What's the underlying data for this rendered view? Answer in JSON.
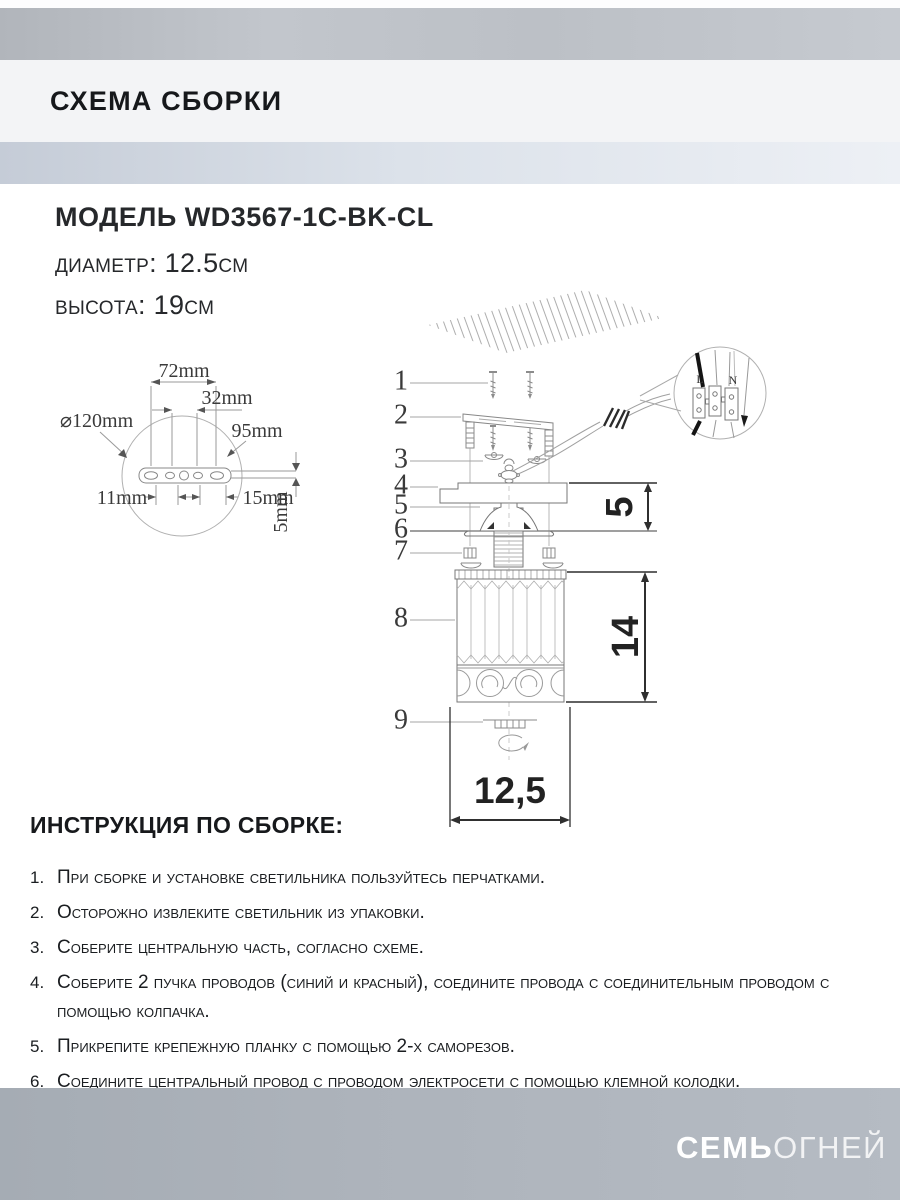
{
  "header": {
    "title": "СХЕМА СБОРКИ"
  },
  "model": {
    "name": "МОДЕЛЬ WD3567-1C-BK-CL",
    "diameter": "диаметр: 12.5см",
    "height": "высота: 19см"
  },
  "diagram": {
    "callouts": [
      "1",
      "2",
      "3",
      "4",
      "5",
      "6",
      "7",
      "8",
      "9"
    ],
    "bracket": {
      "diameter": "⌀120mm",
      "top": "72mm",
      "mid": "32mm",
      "right": "95mm",
      "left_gap": "11mm",
      "right_gap": "15mm",
      "thickness": "5mm"
    },
    "dims": {
      "canopy_height": "5",
      "body_height": "14",
      "body_width": "12,5"
    },
    "terminal": {
      "live": "L",
      "neutral": "N"
    }
  },
  "instructions": {
    "title": "ИНСТРУКЦИЯ ПО СБОРКЕ:",
    "items": [
      {
        "n": "1.",
        "text": "При сборке и установке светильника пользуйтесь перчатками."
      },
      {
        "n": "2.",
        "text": "Осторожно извлеките светильник из упаковки."
      },
      {
        "n": "3.",
        "text": "Соберите центральную часть, согласно схеме."
      },
      {
        "n": "4.",
        "text": "Соберите 2 пучка проводов (синий и красный), соедините провода с соединительным проводом с помощью колпачка."
      },
      {
        "n": "5.",
        "text": "Прикрепите крепежную планку с помощью 2-х саморезов."
      },
      {
        "n": "6.",
        "text": "Соедините центральный провод с проводом электросети с помощью клемной колодки."
      }
    ]
  },
  "footer": {
    "brand_bold": "СЕМЬ",
    "brand_light": "ОГНЕЙ"
  }
}
